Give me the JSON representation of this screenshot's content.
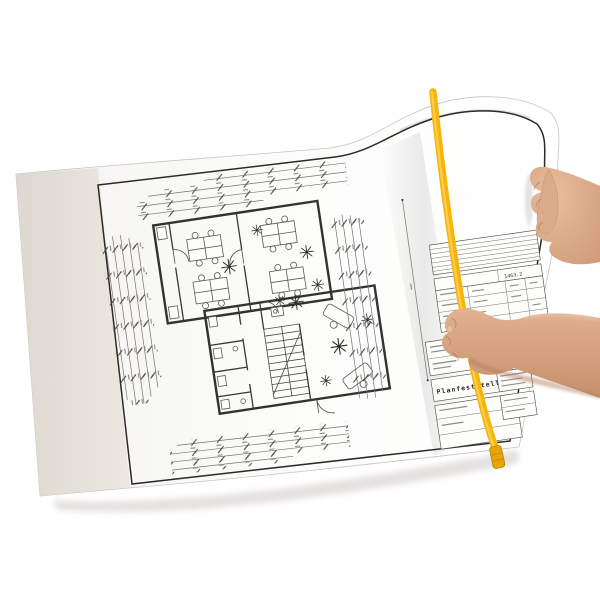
{
  "scene": {
    "kind": "photograph",
    "description": "Two hands hold a large-format architectural floor plan; a yellow plan-fastening strip runs down the right side of the sheet; top-right corner of the sheet is curled upward",
    "background_color": "#ffffff"
  },
  "sheet": {
    "paper_color": "#fcfcfb",
    "backing_color": "#e7e3db",
    "frame_line_color": "#2b2a27",
    "edge_shadow_color": "#d2cfca"
  },
  "drawing": {
    "wall_color": "#34322f",
    "dimension_line_color": "#76746f",
    "dimension_chain_counts": {
      "top": 4,
      "left": 5,
      "right": 5,
      "bottom": 4
    },
    "title_block": {
      "plan_title": "Planfeststellung",
      "plan_number": "1463.2"
    }
  },
  "fastener_strip": {
    "strip_color": "#f6b40f",
    "strip_highlight_color": "#ffd14f",
    "clip_color": "#e9a409"
  },
  "hands": {
    "skin_color": "#d9a788",
    "skin_shadow_color": "#b07a58"
  }
}
